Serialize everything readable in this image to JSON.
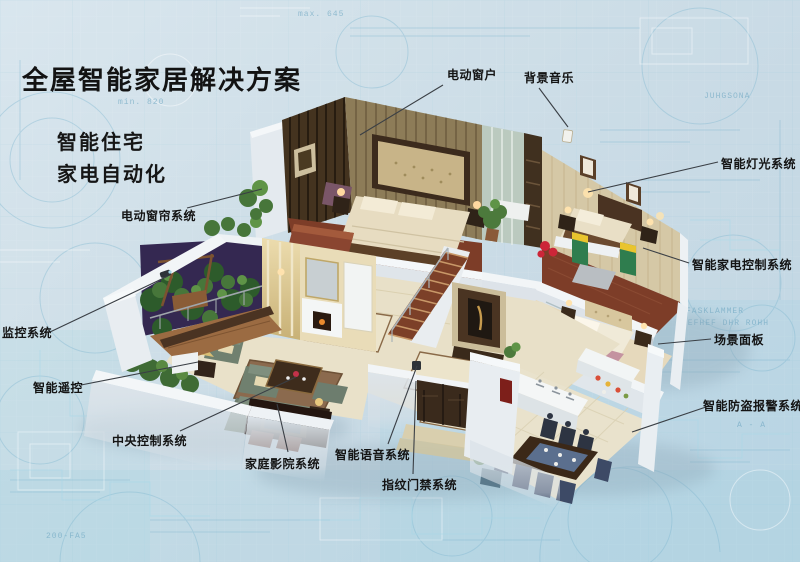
{
  "title": "全屋智能家居解决方案",
  "subtitle_lines": [
    "智能住宅",
    "家电自动化"
  ],
  "callouts": [
    {
      "id": "electric-window",
      "text": "电动窗户",
      "tx": 447,
      "ty": 66,
      "x1": 443,
      "y1": 85,
      "x2": 360,
      "y2": 135
    },
    {
      "id": "background-music",
      "text": "背景音乐",
      "tx": 524,
      "ty": 69,
      "x1": 539,
      "y1": 88,
      "x2": 568,
      "y2": 127
    },
    {
      "id": "smart-lighting",
      "text": "智能灯光系统",
      "tx": 721,
      "ty": 155,
      "x1": 718,
      "y1": 162,
      "x2": 588,
      "y2": 192
    },
    {
      "id": "appliance-control",
      "text": "智能家电控制系统",
      "tx": 692,
      "ty": 256,
      "x1": 689,
      "y1": 263,
      "x2": 643,
      "y2": 248
    },
    {
      "id": "scene-panel",
      "text": "场景面板",
      "tx": 714,
      "ty": 331,
      "x1": 711,
      "y1": 339,
      "x2": 658,
      "y2": 344
    },
    {
      "id": "burglar-alarm",
      "text": "智能防盗报警系统",
      "tx": 703,
      "ty": 397,
      "x1": 706,
      "y1": 407,
      "x2": 632,
      "y2": 432
    },
    {
      "id": "electric-curtain",
      "text": "电动窗帘系统",
      "tx": 121,
      "ty": 207,
      "x1": 187,
      "y1": 208,
      "x2": 262,
      "y2": 189
    },
    {
      "id": "monitoring",
      "text": "监控系统",
      "tx": 2,
      "ty": 324,
      "x1": 50,
      "y1": 332,
      "x2": 168,
      "y2": 276
    },
    {
      "id": "smart-remote",
      "text": "智能遥控",
      "tx": 33,
      "ty": 379,
      "x1": 81,
      "y1": 385,
      "x2": 198,
      "y2": 362
    },
    {
      "id": "central-control",
      "text": "中央控制系统",
      "tx": 112,
      "ty": 432,
      "x1": 180,
      "y1": 431,
      "x2": 296,
      "y2": 377
    },
    {
      "id": "home-theater",
      "text": "家庭影院系统",
      "tx": 245,
      "ty": 455,
      "x1": 288,
      "y1": 452,
      "x2": 277,
      "y2": 404
    },
    {
      "id": "voice-system",
      "text": "智能语音系统",
      "tx": 335,
      "ty": 446,
      "x1": 388,
      "y1": 444,
      "x2": 417,
      "y2": 366
    },
    {
      "id": "fingerprint-access",
      "text": "指纹门禁系统",
      "tx": 382,
      "ty": 476,
      "x1": 413,
      "y1": 474,
      "x2": 416,
      "y2": 381
    }
  ],
  "blueprint_fragments": [
    {
      "text": "min. 820",
      "x": 118,
      "y": 104
    },
    {
      "text": "max. 645",
      "x": 298,
      "y": 16
    },
    {
      "text": "JUHGSONA",
      "x": 704,
      "y": 98
    },
    {
      "text": "FASKLAMMER",
      "x": 686,
      "y": 313
    },
    {
      "text": "GEFHEF DHR ROHH",
      "x": 682,
      "y": 325
    },
    {
      "text": "A - A",
      "x": 737,
      "y": 427
    },
    {
      "text": "200-FA5",
      "x": 46,
      "y": 538
    }
  ],
  "colors": {
    "background": "#cfdfe8",
    "blueprint_line": "#7fb7d0",
    "label_text": "#141414",
    "leader_line": "#3a3f45",
    "wood_dark": "#3c2d1f",
    "wallpaper": "#d5c8a6",
    "floor_wood": "#7d3d28",
    "floor_marble": "#e8e0c8",
    "cabinet_green": "#2f7d4e",
    "cabinet_yellow": "#e9c42e"
  }
}
